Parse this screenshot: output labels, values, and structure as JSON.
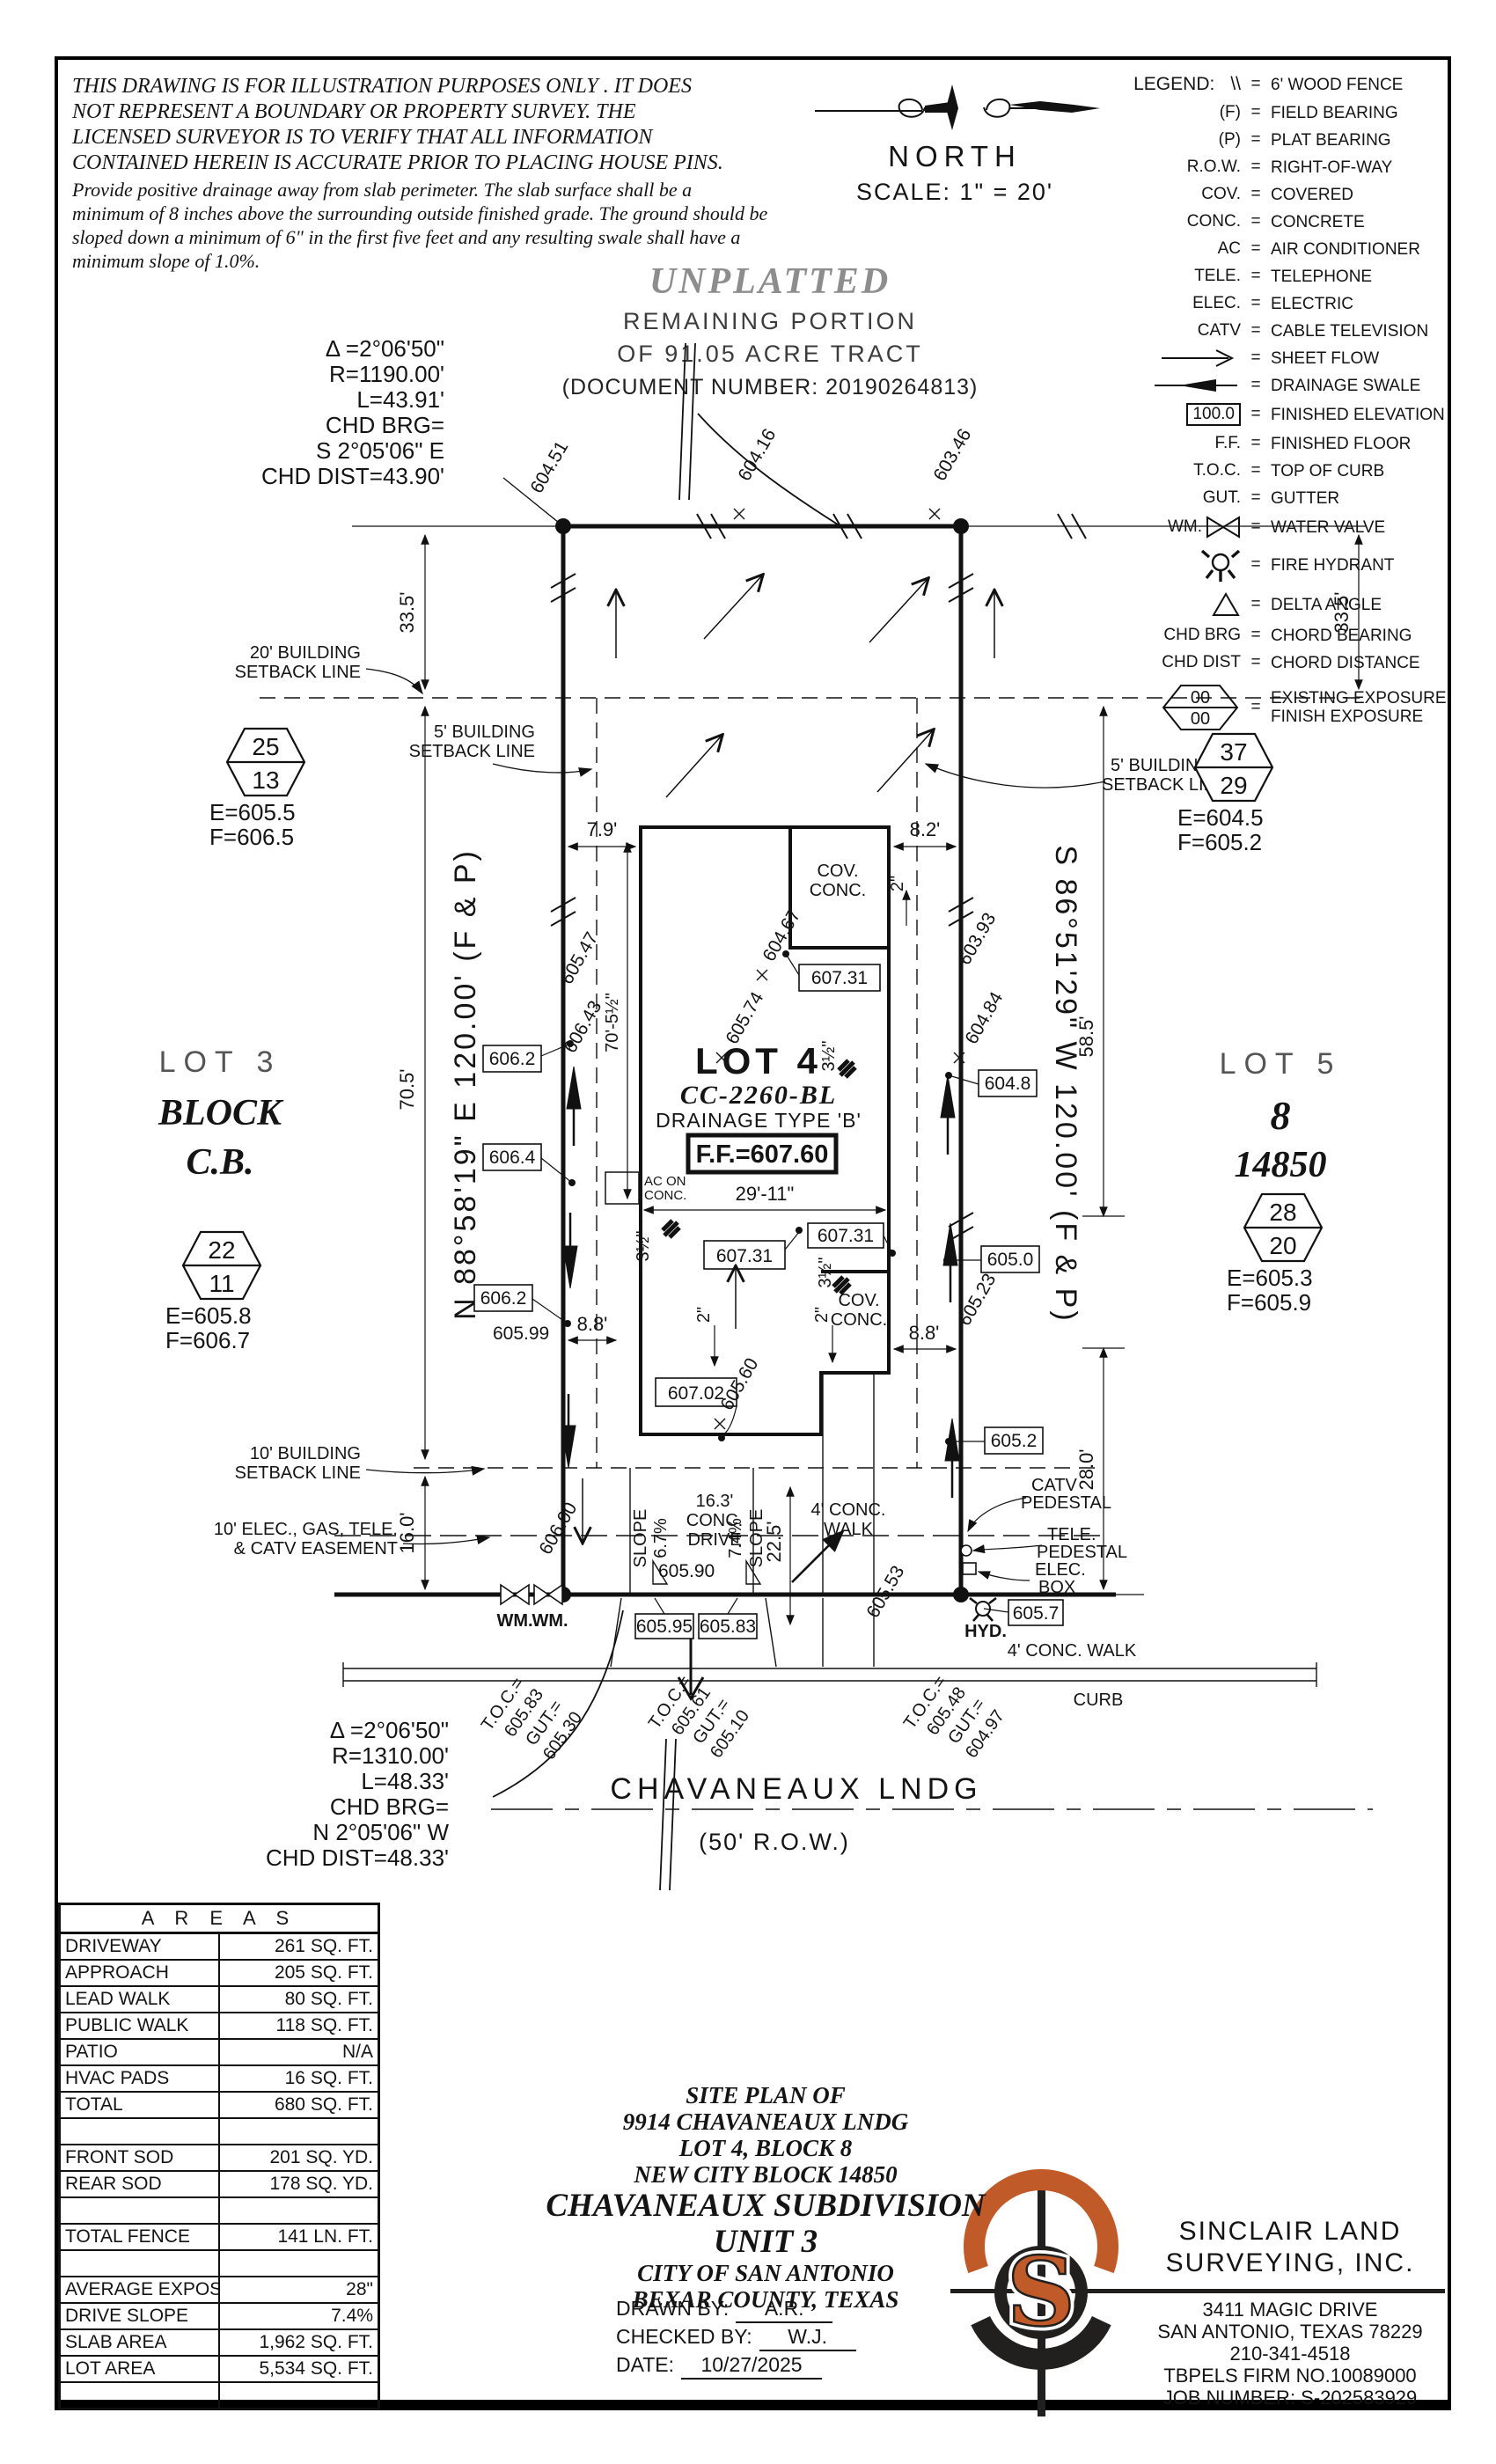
{
  "disclaimer": {
    "caps": "THIS DRAWING IS FOR ILLUSTRATION PURPOSES ONLY . IT DOES\nNOT REPRESENT A BOUNDARY OR PROPERTY SURVEY. THE\nLICENSED SURVEYOR IS TO VERIFY THAT ALL INFORMATION\nCONTAINED HEREIN IS ACCURATE PRIOR TO PLACING HOUSE PINS.",
    "note": "Provide positive drainage away from slab perimeter. The slab surface shall be a\nminimum of 8 inches above the surrounding outside finished grade. The ground should be\nsloped down a minimum of 6\" in the first five feet and any resulting swale shall have a\nminimum slope of 1.0%."
  },
  "north": {
    "label": "NORTH",
    "scale": "SCALE:  1\" =  20'"
  },
  "legend": {
    "title": "LEGEND:",
    "items": [
      {
        "abbr": "\\\\",
        "desc": "6' WOOD FENCE"
      },
      {
        "abbr": "(F)",
        "desc": "FIELD BEARING"
      },
      {
        "abbr": "(P)",
        "desc": "PLAT BEARING"
      },
      {
        "abbr": "R.O.W.",
        "desc": "RIGHT-OF-WAY"
      },
      {
        "abbr": "COV.",
        "desc": "COVERED"
      },
      {
        "abbr": "CONC.",
        "desc": "CONCRETE"
      },
      {
        "abbr": "AC",
        "desc": "AIR CONDITIONER"
      },
      {
        "abbr": "TELE.",
        "desc": "TELEPHONE"
      },
      {
        "abbr": "ELEC.",
        "desc": "ELECTRIC"
      },
      {
        "abbr": "CATV",
        "desc": "CABLE TELEVISION"
      },
      {
        "abbr": "",
        "desc": "SHEET FLOW"
      },
      {
        "abbr": "",
        "desc": "DRAINAGE SWALE"
      },
      {
        "abbr": "100.0",
        "desc": "FINISHED ELEVATION"
      },
      {
        "abbr": "F.F.",
        "desc": "FINISHED FLOOR"
      },
      {
        "abbr": "T.O.C.",
        "desc": "TOP OF CURB"
      },
      {
        "abbr": "GUT.",
        "desc": "GUTTER"
      },
      {
        "abbr": "WM.",
        "desc": "WATER VALVE"
      },
      {
        "abbr": "",
        "desc": "FIRE HYDRANT"
      },
      {
        "abbr": "",
        "desc": "DELTA ANGLE"
      },
      {
        "abbr": "CHD BRG",
        "desc": "CHORD BEARING"
      },
      {
        "abbr": "CHD DIST",
        "desc": "CHORD DISTANCE"
      },
      {
        "abbr": "00 00",
        "desc": "EXISTING EXPOSURE",
        "desc2": "FINISH EXPOSURE"
      }
    ]
  },
  "unplatted": {
    "title": "UNPLATTED",
    "line1": "REMAINING PORTION",
    "line2": "OF 91.05 ACRE TRACT",
    "line3": "(DOCUMENT NUMBER:  20190264813)"
  },
  "curve_top": {
    "l1": "Δ =2°06'50\"",
    "l2": "R=1190.00'",
    "l3": "L=43.91'",
    "l4": "CHD BRG=",
    "l5": "S 2°05'06\" E",
    "l6": "CHD DIST=43.90'"
  },
  "curve_bottom": {
    "l1": "Δ =2°06'50\"",
    "l2": "R=1310.00'",
    "l3": "L=48.33'",
    "l4": "CHD BRG=",
    "l5": "N 2°05'06\" W",
    "l6": "CHD DIST=48.33'"
  },
  "adjacent": {
    "lot3": "LOT 3",
    "block": "BLOCK",
    "cb": "C.B.",
    "lot5": "LOT 5",
    "eight": "8",
    "ncb": "14850"
  },
  "exposure_markers": [
    {
      "top": "25",
      "bottom": "13",
      "e": "E=605.5",
      "f": "F=606.5"
    },
    {
      "top": "37",
      "bottom": "29",
      "e": "E=604.5",
      "f": "F=605.2"
    },
    {
      "top": "22",
      "bottom": "11",
      "e": "E=605.8",
      "f": "F=606.7"
    },
    {
      "top": "28",
      "bottom": "20",
      "e": "E=605.3",
      "f": "F=605.9"
    }
  ],
  "plan": {
    "bearing_left": "N 88°58'19\" E 120.00' (F & P)",
    "bearing_right": "S 86°51'29\" W 120.00' (F & P)",
    "setback20_1": "20' BUILDING",
    "setback20_2": "SETBACK LINE",
    "setback5l_1": "5' BUILDING",
    "setback5l_2": "SETBACK LINE",
    "setback5r_1": "5' BUILDING",
    "setback5r_2": "SETBACK LINE",
    "setback10_1": "10' BUILDING",
    "setback10_2": "SETBACK LINE",
    "easement_1": "10' ELEC., GAS, TELE.",
    "easement_2": "& CATV EASEMENT",
    "dims": {
      "d33l": "33.5'",
      "d33r": "33.5'",
      "d705": "70.5'",
      "d585": "58.5'",
      "d160": "16.0'",
      "d280": "28.0'",
      "d79": "7.9'",
      "d82": "8.2'",
      "d2911": "29'-11\"",
      "d7052": "70'-5½\"",
      "d88a": "8.8'",
      "d88b": "8.8'",
      "d225": "22.5'"
    },
    "lot4": {
      "name": "LOT 4",
      "cc": "CC-2260-BL",
      "drain": "DRAINAGE TYPE 'B'",
      "ff": "F.F.=607.60"
    },
    "boxed": [
      "606.2",
      "606.4",
      "606.2",
      "604.8",
      "605.0",
      "605.2",
      "605.7",
      "607.31",
      "607.31",
      "607.31",
      "607.02",
      "605.95",
      "605.83"
    ],
    "spots": [
      "604.51",
      "604.16",
      "603.46",
      "605.47",
      "604.67",
      "603.93",
      "606.43",
      "605.74",
      "604.84",
      "605.99",
      "605.90",
      "605.60",
      "605.23",
      "606.00",
      "605.53"
    ],
    "toc": [
      {
        "a": "T.O.C.=",
        "b": "605.83",
        "c": "GUT.=",
        "d": "605.30"
      },
      {
        "a": "T.O.C.=",
        "b": "605.61",
        "c": "GUT.=",
        "d": "605.10"
      },
      {
        "a": "T.O.C.=",
        "b": "605.48",
        "c": "GUT.=",
        "d": "604.97"
      }
    ],
    "labels": {
      "cov1": "COV.",
      "conc1": "CONC.",
      "cov2": "COV.",
      "conc2": "CONC.",
      "ac1": "AC ON",
      "ac2": "CONC.",
      "wm1": "WM.",
      "wm2": "WM.",
      "hyd": "HYD.",
      "catv1": "CATV",
      "catv2": "PEDESTAL",
      "tele1": "TELE.",
      "tele2": "PEDESTAL",
      "elec1": "ELEC.",
      "elec2": "BOX",
      "drive1": "16.3'",
      "drive2": "CONC.",
      "drive3": "DRIVE",
      "slope_l1": "SLOPE",
      "slope_l2": "6.7%",
      "slope_r1": "7.4%",
      "slope_r2": "SLOPE",
      "walk1": "4' CONC.",
      "walk2": "WALK",
      "walk_front": "4' CONC. WALK",
      "curb": "CURB",
      "t2a": "2\"",
      "t2b": "2\"",
      "t2c": "2\"",
      "t35a": "3½\"",
      "t35b": "3½\"",
      "t35c": "3½\""
    },
    "street": {
      "name": "CHAVANEAUX LNDG",
      "row": "(50' R.O.W.)"
    }
  },
  "areas": {
    "title": "A R E A S",
    "rows": [
      {
        "label": "DRIVEWAY",
        "value": "261 SQ. FT."
      },
      {
        "label": "APPROACH",
        "value": "205 SQ. FT."
      },
      {
        "label": "LEAD WALK",
        "value": "80 SQ. FT."
      },
      {
        "label": "PUBLIC WALK",
        "value": "118 SQ. FT."
      },
      {
        "label": "PATIO",
        "value": "N/A"
      },
      {
        "label": "HVAC PADS",
        "value": "16 SQ. FT."
      },
      {
        "label": "TOTAL",
        "value": "680 SQ. FT."
      },
      {
        "label": "",
        "value": ""
      },
      {
        "label": "FRONT SOD",
        "value": "201 SQ. YD."
      },
      {
        "label": "REAR SOD",
        "value": "178 SQ. YD."
      },
      {
        "label": "",
        "value": ""
      },
      {
        "label": "TOTAL FENCE",
        "value": "141 LN. FT."
      },
      {
        "label": "",
        "value": ""
      },
      {
        "label": "AVERAGE EXPOSURE",
        "value": "28\""
      },
      {
        "label": "DRIVE SLOPE",
        "value": "7.4%"
      },
      {
        "label": "SLAB AREA",
        "value": "1,962 SQ. FT."
      },
      {
        "label": "LOT AREA",
        "value": "5,534 SQ. FT."
      },
      {
        "label": "",
        "value": ""
      }
    ]
  },
  "titleblock": {
    "l1": "SITE PLAN OF",
    "l2": "9914 CHAVANEAUX LNDG",
    "l3": "LOT 4, BLOCK 8",
    "l4": "NEW CITY BLOCK 14850",
    "l5": "CHAVANEAUX SUBDIVISION",
    "l6": "UNIT 3",
    "l7": "CITY OF SAN ANTONIO",
    "l8": "BEXAR COUNTY, TEXAS",
    "drawn_label": "DRAWN BY:",
    "drawn": "A.R.",
    "checked_label": "CHECKED BY:",
    "checked": "W.J.",
    "date_label": "DATE:",
    "date": "10/27/2025"
  },
  "firm": {
    "name1": "SINCLAIR LAND",
    "name2": "SURVEYING, INC.",
    "addr1": "3411 MAGIC DRIVE",
    "addr2": "SAN ANTONIO, TEXAS 78229",
    "addr3": "210-341-4518",
    "addr4": "TBPELS FIRM NO.10089000",
    "addr5": "JOB NUMBER: S-202583929",
    "logo_s": "S"
  },
  "colors": {
    "orange": "#c05a28",
    "ink": "#141414"
  }
}
